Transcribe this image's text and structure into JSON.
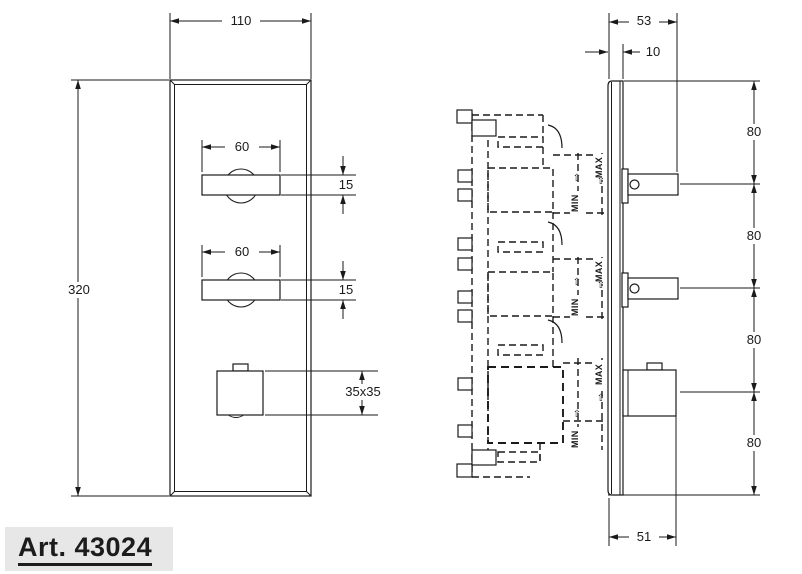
{
  "title_block": {
    "article_label": "Art. 43024"
  },
  "front_view": {
    "overall_width": "110",
    "overall_height": "320",
    "handle_width_top": "60",
    "handle_height_top": "15",
    "handle_width_middle": "60",
    "handle_height_middle": "15",
    "diverter_size": "35x35"
  },
  "side_view": {
    "total_depth": "53",
    "plate_thickness": "10",
    "spacing": [
      "80",
      "80",
      "80",
      "80"
    ],
    "diverter_depth": "51",
    "min_label": "MIN",
    "max_label": "MAX"
  },
  "icons": {
    "up_white_arrow": "⇧"
  },
  "colors": {
    "line": "#1a1a1a",
    "label_background": "#e7e7e7",
    "background": "#ffffff"
  }
}
